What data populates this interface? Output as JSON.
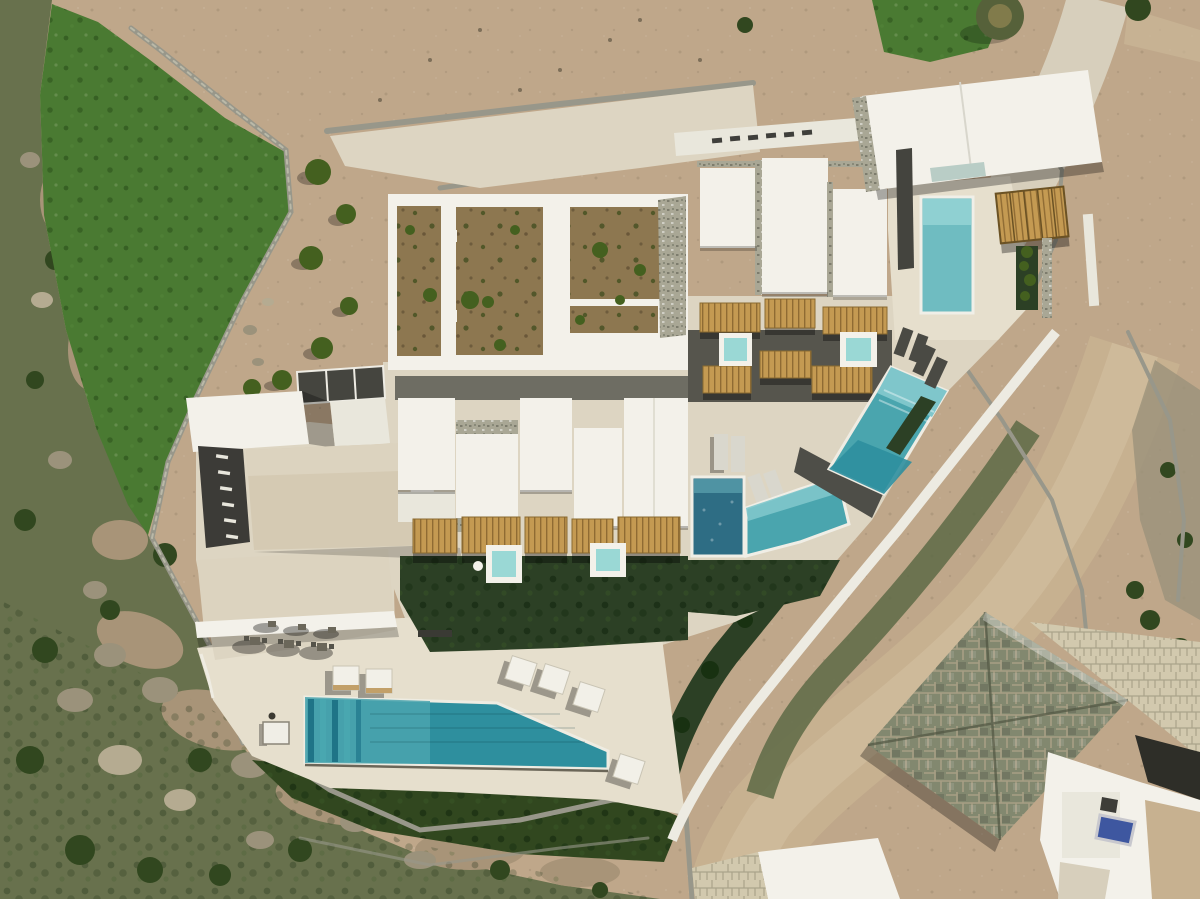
{
  "scene": {
    "type": "aerial-drone-photograph",
    "subject": "Top-down aerial view of a whitewashed flat-roof villa complex with multiple turquoise swimming pools, wooden pergolas, garden plots and terraces, set on a rocky green hillside beside dirt roads and a neighbouring stone-roofed house",
    "features": [
      "main infinity lap pool with lane stripes",
      "diagonal terrace pool",
      "corner chevron pool",
      "dark-blue plunge pool",
      "two private plunge pools in hedge courtyards",
      "two jacuzzi spa tubs",
      "vertical courtyard pool",
      "bamboo pergola canopies",
      "walled vegetable garden plots",
      "parking strip with white bay markings",
      "stone boundary walls",
      "white access ramp",
      "sun daybeds and outdoor dining sets",
      "rocky hillside with shrubs and boulders",
      "neighbouring house with grey stone-tiled roof",
      "dirt road curving along the east side"
    ]
  },
  "palette": {
    "dirt": "#bfa78a",
    "dirtPath": "#cbb697",
    "concrete": "#d7cfbc",
    "road": "#c7b190",
    "roadLight": "#d3bf9f",
    "meadow": "#4a7a32",
    "meadowDark": "#2f5520",
    "hillside": "#68714d",
    "hillTan": "#a89478",
    "rock": "#9b927b",
    "rockLight": "#b5ab91",
    "bush": "#31471f",
    "hedge": "#2c4025",
    "plant": "#44601f",
    "soil": "#8d7750",
    "wall": "#98978a",
    "wallLight": "#bab9a8",
    "white": "#f3f1ea",
    "whiteDim": "#e9e7dc",
    "stoneTrim": "#a9a795",
    "terrace": "#ddd5c2",
    "terraceLight": "#e6dfcd",
    "deckDark": "#4e4e48",
    "asphalt": "#3c3b37",
    "darkStructure": "#45453f",
    "roofBeige": "#d5cab3",
    "roofBeigeLight": "#dcd3bf",
    "poolDeep": "#2e8f9e",
    "poolMid": "#4aa5ae",
    "poolShallow": "#7fc6cb",
    "poolPale": "#9ad8d5",
    "poolNavy": "#2e6d84",
    "poolNavyLight": "#4f93a3",
    "poolA": "#6fbcc1",
    "poolALight": "#8fd0d2",
    "pergola": "#c49a52",
    "pergolaDark": "#7c5f2b",
    "skylight": "#b9cdc6",
    "solarBlue": "#3e57a0",
    "neighborRoof": "#82886f",
    "neighborGrout": "#b0a489",
    "pebble": "#d2c9ae",
    "treeOlive": "#56613a"
  }
}
